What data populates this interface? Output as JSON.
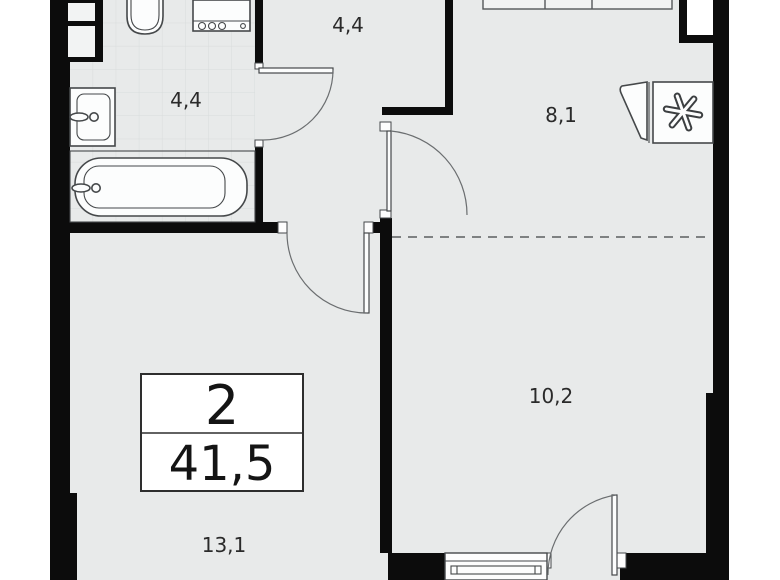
{
  "title": "apartment-floor-plan",
  "summary": {
    "rooms": "2",
    "total_area": "41,5"
  },
  "rooms": {
    "bathroom": {
      "label": "4,4"
    },
    "hallway": {
      "label": "4,4"
    },
    "kitchen": {
      "label": "8,1"
    },
    "bedroom_zone": {
      "label": "10,2"
    },
    "living_zone": {
      "label": "13,1"
    }
  },
  "icons": {
    "refrigerator": "asterisk-snowflake-icon",
    "fixtures": [
      "toilet",
      "washing-machine",
      "sink",
      "bathtub",
      "kitchen-counter",
      "window",
      "balcony-door"
    ]
  },
  "colors": {
    "wall": "#0c0c0c",
    "floor": "#e8eaea",
    "background": "#ffffff",
    "outline": "#45484a",
    "tile": "#d8dcdc",
    "text": "#2a2a2a"
  }
}
